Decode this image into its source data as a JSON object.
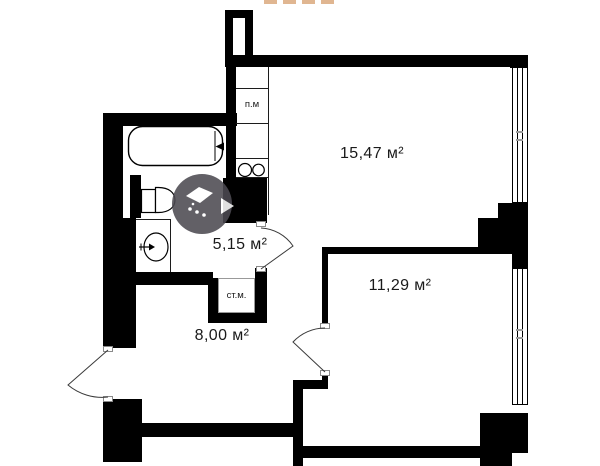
{
  "title": "Apartment floor plan",
  "colors": {
    "background": "#ffffff",
    "wall": "#000000",
    "text": "#1a1a1a",
    "jamb_border": "#8a8a8a",
    "watermark_circle": "#4d4b52",
    "watermark_dash": "#daa97e"
  },
  "rooms": [
    {
      "name": "room-1",
      "area_label": "15,47 м²"
    },
    {
      "name": "room-2",
      "area_label": "11,29 м²"
    },
    {
      "name": "bathroom",
      "area_label": "5,15 м²"
    },
    {
      "name": "hallway",
      "area_label": "8,00 м²"
    }
  ],
  "annotations": {
    "washer_place": "п.м",
    "washing_machine": "ст.м."
  },
  "icons": {
    "fixtures": [
      "bathtub-icon",
      "toilet-icon",
      "sink-icon",
      "stove-burners-icon"
    ],
    "watermark": "developer-logo-watermark"
  }
}
